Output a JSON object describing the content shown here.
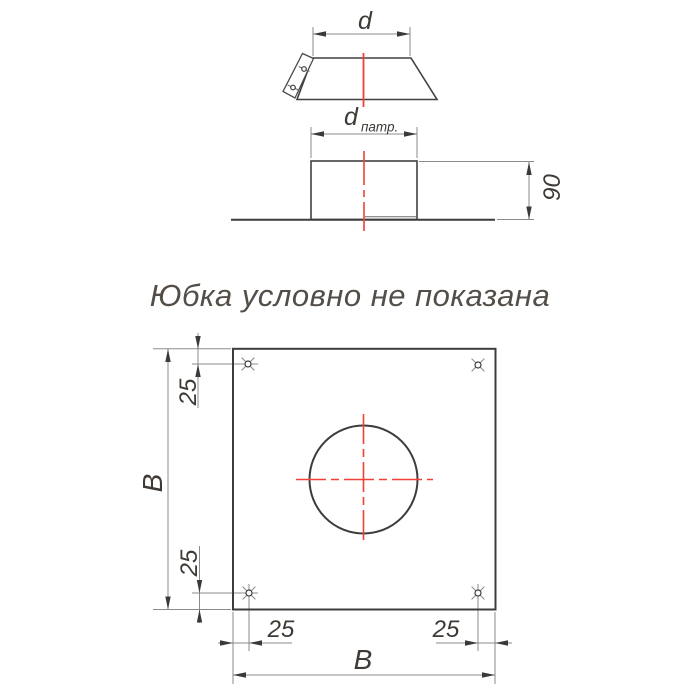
{
  "colors": {
    "outline": "#3c3c3c",
    "dimension_line": "#8b8b8b",
    "text": "#3f3a35",
    "centerline": "#ef4136",
    "title": "#544e48",
    "background": "#ffffff"
  },
  "note": {
    "text": "Юбка условно не показана"
  },
  "views": {
    "skirt_top": {
      "labels": {
        "d": "d"
      }
    },
    "front": {
      "labels": {
        "d_base": "d",
        "d_sub": "патр.",
        "height": "90"
      }
    },
    "plan": {
      "labels": {
        "width": "B",
        "height": "B",
        "offset_top": "25",
        "offset_bottom": "25",
        "offset_left": "25",
        "offset_right": "25"
      }
    }
  }
}
